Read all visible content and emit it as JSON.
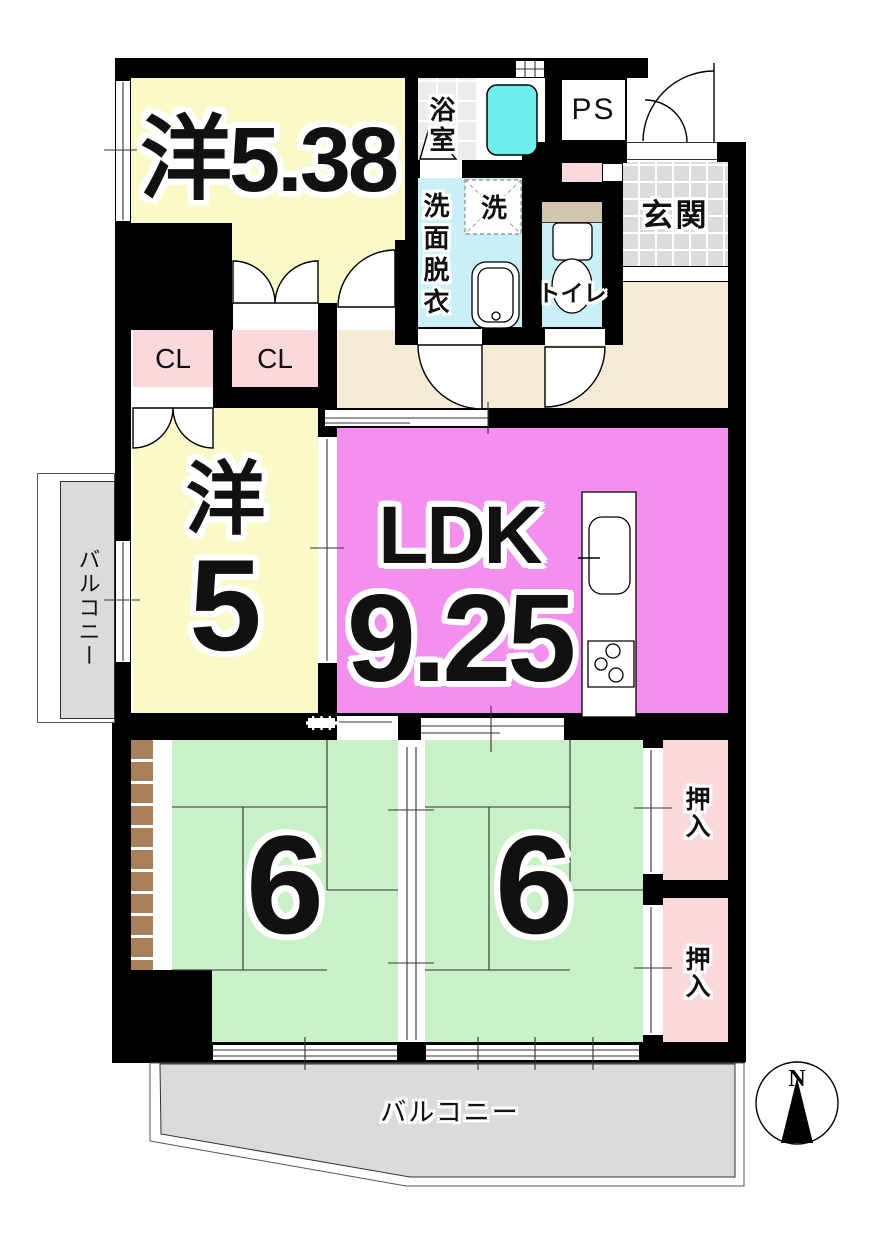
{
  "colors": {
    "wall": "#000000",
    "room_yellow": "#FAFAC8",
    "ldk_violet": "#F48FF0",
    "tatami_green": "#C9F1C7",
    "closet_pink": "#FAD9DC",
    "water_cyan": "#C9EFF7",
    "bathtub_cyan": "#6FEEF0",
    "genkan_gray": "#DCDCDC",
    "balcony_gray": "#DBDBDB",
    "hall_beige": "#F4EBD7",
    "hatch_brown": "#A8805C",
    "shelf_tan": "#D2C6AF"
  },
  "rooms": {
    "western_538": {
      "label": "洋5.38"
    },
    "bath": {
      "label": "浴室"
    },
    "washer": {
      "label": "洗"
    },
    "washroom": {
      "label": "洗面脱衣"
    },
    "toilet": {
      "label": "トイレ"
    },
    "pipe_space": {
      "label": "PS"
    },
    "entrance": {
      "label": "玄関"
    },
    "closet_1": {
      "label": "CL"
    },
    "closet_2": {
      "label": "CL"
    },
    "western_5": {
      "kanji": "洋",
      "size": "5"
    },
    "ldk": {
      "label": "LDK",
      "size": "9.25"
    },
    "tatami_left": {
      "size": "6"
    },
    "tatami_right": {
      "size": "6"
    },
    "oshiire_top": {
      "label": "押入"
    },
    "oshiire_bottom": {
      "label": "押入"
    },
    "balcony_left": {
      "label": "バルコニー"
    },
    "balcony_bottom": {
      "label": "バルコニー"
    }
  },
  "compass": {
    "north_label": "N"
  }
}
